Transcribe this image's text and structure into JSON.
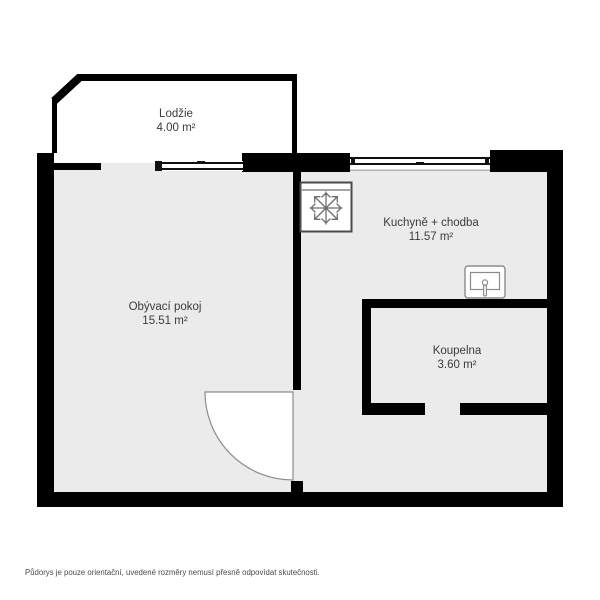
{
  "rooms": {
    "loggia": {
      "name": "Lodžie",
      "area": "4.00 m²"
    },
    "living_room": {
      "name": "Obývací pokoj",
      "area": "15.51 m²"
    },
    "kitchen_hall": {
      "name": "Kuchyně + chodba",
      "area": "11.57 m²"
    },
    "bathroom": {
      "name": "Koupelna",
      "area": "3.60 m²"
    }
  },
  "icons": {
    "fridge": "snowflake-icon",
    "sink": "sink-icon"
  },
  "footer": {
    "disclaimer": "Půdorys je pouze orientační, uvedené rozměry nemusí přesně odpovídat skutečnosti."
  },
  "colors": {
    "wall": "#000000",
    "floor": "#ebebeb",
    "loggia_floor": "#ffffff",
    "window": "#111111",
    "door": "#8c8c8c",
    "fixture": "#8c8c8c",
    "fixture_mid": "#6e6e6e",
    "fixture_dark": "#4a4a4a",
    "label": "#3b3b3b",
    "muted": "#4b4b4b"
  }
}
